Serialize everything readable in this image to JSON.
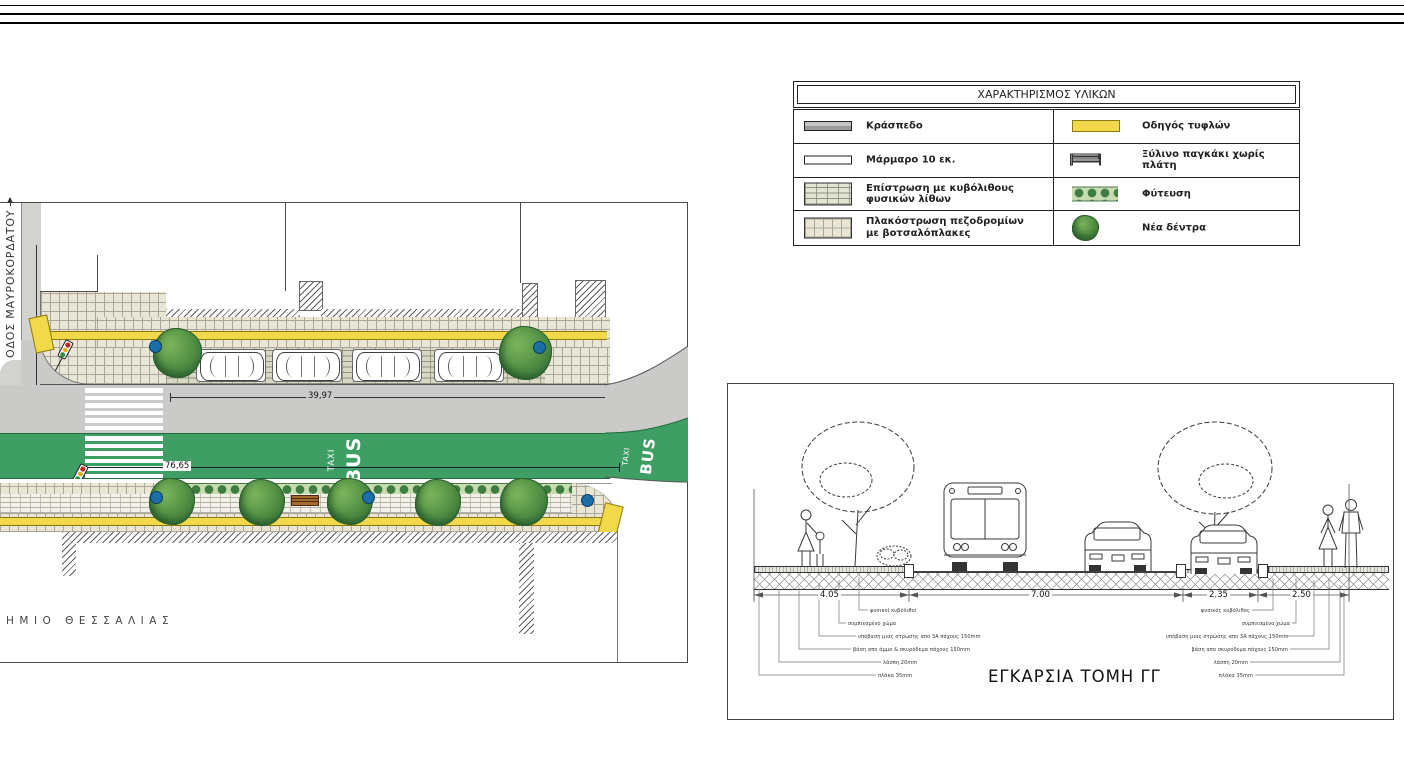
{
  "legend": {
    "title": "ΧΑΡΑΚΤΗΡΙΣΜΟΣ ΥΛΙΚΩΝ",
    "rows": [
      {
        "left_label": "Κράσπεδο",
        "right_label": "Οδηγός τυφλών"
      },
      {
        "left_label": "Μάρμαρο 10 εκ.",
        "right_label": "Ξύλινο παγκάκι χωρίς πλάτη"
      },
      {
        "left_label": "Επίστρωση με κυβόλιθους φυσικών λίθων",
        "right_label": "Φύτευση"
      },
      {
        "left_label": "Πλακόστρωση πεζοδρομίων",
        "left_label_line2": "με βοτσαλόπλακες",
        "right_label": "Νέα δέντρα"
      }
    ]
  },
  "plan": {
    "street_label": "ΟΔΟΣ ΜΑΥΡΟΚΟΡΔΑΤΟΥ",
    "bottom_label": "ΗΜΙΟ ΘΕΣΣΑΛΙΑΣ",
    "dim_parking_row": "39,97",
    "dim_total": "76,65",
    "bus_lane_label": "BUS",
    "bus_lane_sublabel": "TAXI",
    "bus_lane_label_2": "BUS",
    "bus_lane_sublabel_2": "TAXI"
  },
  "section": {
    "title": "ΕΓΚΑΡΣΙΑ ΤΟΜΗ ΓΓ",
    "dims": [
      "4.05",
      "7.00",
      "2.35",
      "2.50"
    ],
    "callouts_left": [
      "φυσικοί κυβόλιθοι",
      "συμπιεσμένο χώμα",
      "υπόβαση μιας στρώσης απο 3Α πάχους 150mm",
      "βάση απο άμμο & σκυρόδεμα πάχους 150mm",
      "λάσπη 20mm",
      "πλάκα 35mm"
    ],
    "callouts_right": [
      "φυσικός κυβόλιθος",
      "συμπιεσμένο χώμα",
      "υπόβαση μιας στρώσης απο 3Α πάχους 150mm",
      "βάση απο σκυρόδεμα πάχους 150mm",
      "λάσπη 20mm",
      "πλάκα 35mm"
    ]
  },
  "colors": {
    "bus_lane_green": "#3F9E63",
    "tactile_yellow": "#F2D84B",
    "sidewalk_beige": "#EAE6D6",
    "road_gray": "#CACAC8",
    "tree_green": "#4E8C42",
    "bollard_blue": "#1B6FA9"
  }
}
